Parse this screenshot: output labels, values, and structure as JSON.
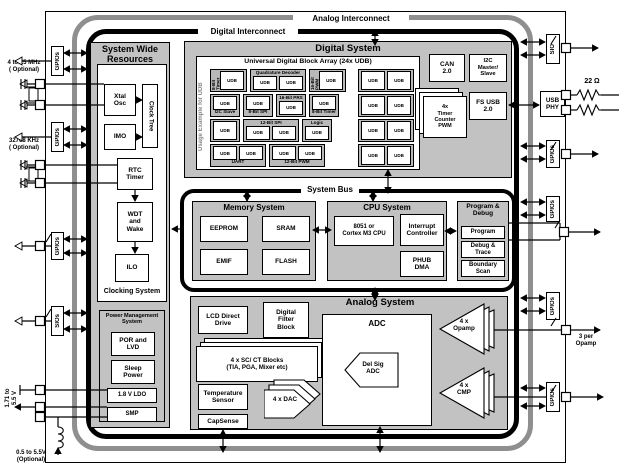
{
  "buses": {
    "analog_interconnect": "Analog Interconnect",
    "digital_interconnect": "Digital Interconnect",
    "system_bus": "System Bus"
  },
  "external": {
    "xtal_high": "4 to 25 MHz\n( Optional)",
    "xtal_low": "32768 KHz\n( Optional)",
    "supply_range": "1.71 to\n5.5 V",
    "boost_supply": "0.5 to 5.5V\n(Optional)",
    "usb_resistor": "22 Ω",
    "opamp_note": "3 per\nOpamp"
  },
  "ports_left": [
    "GPIOs",
    "GPIOs",
    "GPIOs",
    "SIOs"
  ],
  "ports_right": [
    "SIO",
    "GPIOs",
    "GPIOs",
    "GPIOs",
    "GPIOs"
  ],
  "usb_phy": "USB\nPHY",
  "system_wide": {
    "title": "System Wide\nResources",
    "clocking": {
      "caption": "Clocking System",
      "xtal_osc": "Xtal\nOsc",
      "clock_tree": "Clock Tree",
      "imo": "IMO",
      "rtc": "RTC\nTimer",
      "wdt": "WDT\nand\nWake",
      "ilo": "ILO"
    },
    "power": {
      "title": "Power Management\nSystem",
      "por": "POR and\nLVD",
      "sleep": "Sleep\nPower",
      "ldo": "1.8 V LDO",
      "smp": "SMP"
    }
  },
  "digital_system": {
    "title": "Digital System",
    "udb_array": {
      "title": "Universal Digital Block Array (24x UDB)",
      "side_label": "Usage Example for UDB",
      "cell": "UDB",
      "rows": [
        [
          {
            "label": "8-Bit Timer",
            "pos": "left",
            "n": 1
          },
          {
            "label": "Quadrature Decoder",
            "pos": "top",
            "n": 2
          },
          {
            "label": "16-Bit PWM",
            "pos": "left",
            "n": 1
          },
          {
            "label": "",
            "pos": "none",
            "n": 2
          }
        ],
        [
          {
            "label": "I2C Slave",
            "pos": "bottom",
            "n": 1
          },
          {
            "label": "8-Bit SPI",
            "pos": "bottom",
            "n": 1
          },
          {
            "label": "16-Bit PRS",
            "pos": "top",
            "n": 1
          },
          {
            "label": "8-Bit Timer",
            "pos": "bottom",
            "n": 1
          },
          {
            "label": "",
            "pos": "none",
            "n": 2
          }
        ],
        [
          {
            "label": "",
            "pos": "none",
            "n": 1
          },
          {
            "label": "12-Bit SPI",
            "pos": "top",
            "n": 2
          },
          {
            "label": "Logic",
            "pos": "top",
            "n": 1
          },
          {
            "label": "",
            "pos": "none",
            "n": 2
          }
        ],
        [
          {
            "label": "UART",
            "pos": "bottom",
            "n": 2
          },
          {
            "label": "12-Bit PWM",
            "pos": "bottom",
            "n": 2
          },
          {
            "label": "",
            "pos": "none",
            "n": 2
          }
        ]
      ]
    },
    "can": "CAN\n2.0",
    "i2c": "I2C\nMaster/\nSlave",
    "fs_usb": "FS USB\n2.0",
    "timers": "4x\nTimer\nCounter\nPWM"
  },
  "memory_system": {
    "title": "Memory System",
    "eeprom": "EEPROM",
    "sram": "SRAM",
    "emif": "EMIF",
    "flash": "FLASH"
  },
  "cpu_system": {
    "title": "CPU System",
    "core": "8051 or\nCortex M3 CPU",
    "interrupt": "Interrupt\nController",
    "phub": "PHUB\nDMA"
  },
  "program_debug": {
    "title": "Program &\nDebug",
    "program": "Program",
    "trace": "Debug &\nTrace",
    "boundary": "Boundary\nScan"
  },
  "analog_system": {
    "title": "Analog System",
    "lcd": "LCD Direct\nDrive",
    "dfb": "Digital\nFilter\nBlock",
    "scct": "4 x SC/ CT Blocks\n(TIA, PGA, Mixer etc)",
    "temp": "Temperature\nSensor",
    "capsense": "CapSense",
    "dac": "4 x DAC",
    "adc": "ADC",
    "delsig": "Del Sig\nADC",
    "opamp": "4 x\nOpamp",
    "cmp": "4 x\nCMP"
  },
  "colors": {
    "box_gray": "#c2c2c2",
    "udb_gray": "#b9b9b9",
    "ring_gray": "#8f8f8f",
    "line_black": "#000000"
  }
}
